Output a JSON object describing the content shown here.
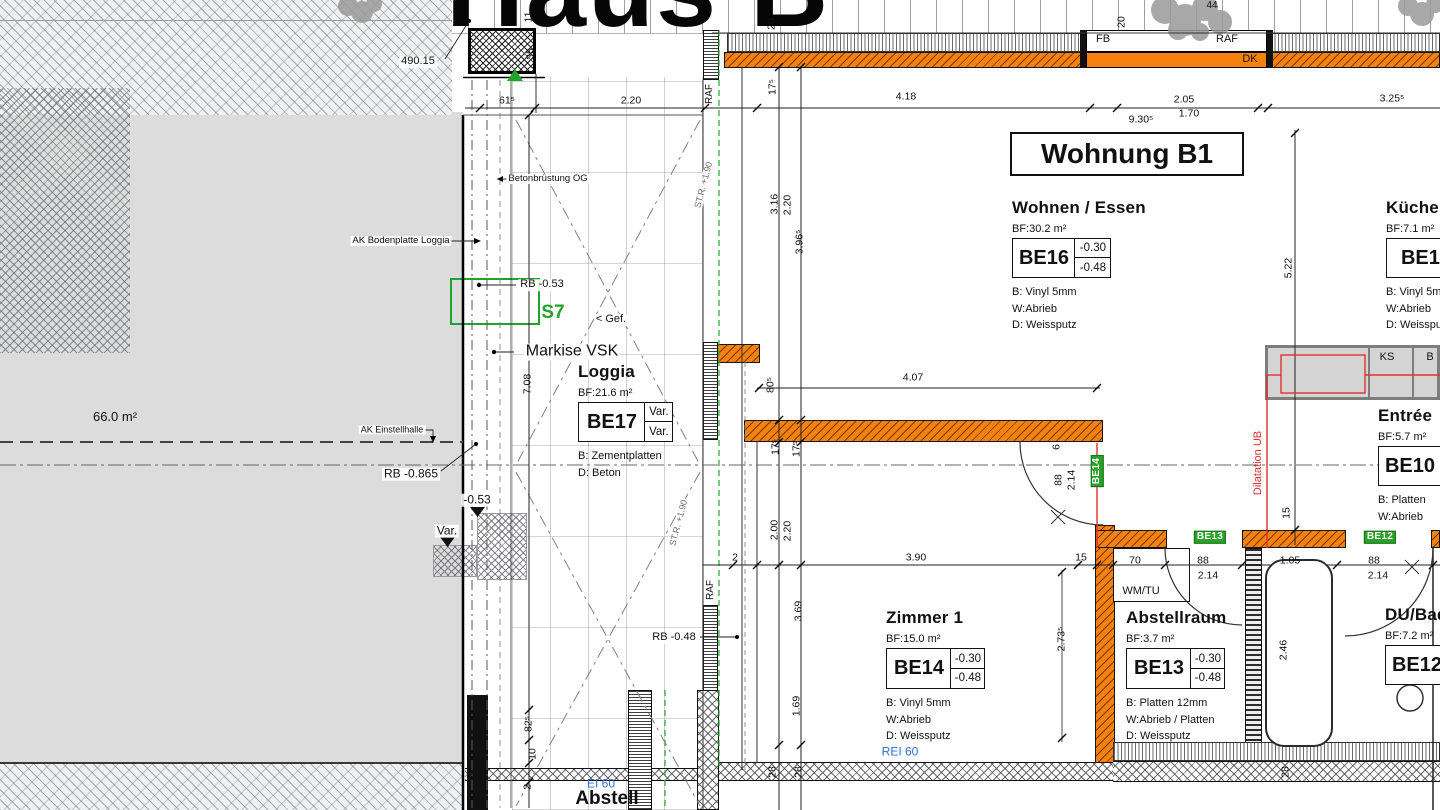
{
  "sheet_title": "Haus B",
  "apartment_title": "Wohnung B1",
  "colors": {
    "wall_orange": "#F5820F",
    "accent_green": "#1FA32A",
    "accent_red": "#DF312B",
    "fire_blue": "#2E6FD2",
    "hall_gray": "#DCDCDC"
  },
  "rooms": {
    "wohnen": {
      "name": "Wohnen / Essen",
      "area": "BF:30.2 m²",
      "code": "BE16",
      "lv1": "-0.30",
      "lv2": "-0.48",
      "layers": [
        "B: Vinyl 5mm",
        "W:Abrieb",
        "D: Weissputz"
      ]
    },
    "kueche": {
      "name": "Küche",
      "area": "BF:7.1 m²",
      "code": "BE15",
      "layers": [
        "B: Vinyl 5mm",
        "W:Abrieb",
        "D: Weissputz"
      ]
    },
    "loggia": {
      "name": "Loggia",
      "area": "BF:21.6 m²",
      "code": "BE17",
      "lv1": "Var.",
      "lv2": "Var.",
      "layers": [
        "B: Zementplatten",
        "D: Beton"
      ]
    },
    "entree": {
      "name": "Entrée",
      "area": "BF:5.7 m²",
      "code": "BE10",
      "layers": [
        "B: Platten",
        "W:Abrieb"
      ]
    },
    "zimmer1": {
      "name": "Zimmer 1",
      "area": "BF:15.0 m²",
      "code": "BE14",
      "lv1": "-0.30",
      "lv2": "-0.48",
      "layers": [
        "B: Vinyl 5mm",
        "W:Abrieb",
        "D: Weissputz"
      ]
    },
    "abstellraum": {
      "name": "Abstellraum",
      "area": "BF:3.7 m²",
      "code": "BE13",
      "lv1": "-0.30",
      "lv2": "-0.48",
      "layers": [
        "B: Platten 12mm",
        "W:Abrieb / Platten",
        "D: Weissputz"
      ]
    },
    "dubad": {
      "name": "DU/Bad",
      "area": "BF:7.2 m²",
      "code": "BE12",
      "layers": []
    }
  },
  "dims": [
    {
      "t": "11",
      "x": 529,
      "y": 17,
      "r": -90
    },
    {
      "t": "35",
      "x": 531,
      "y": 54,
      "r": -90
    },
    {
      "t": "61⁵",
      "x": 507,
      "y": 101
    },
    {
      "t": "2.20",
      "x": 631,
      "y": 101
    },
    {
      "t": "20",
      "x": 772,
      "y": 24,
      "r": -90
    },
    {
      "t": "17⁵",
      "x": 773,
      "y": 87,
      "r": -90
    },
    {
      "t": "20",
      "x": 1122,
      "y": 22,
      "r": -90
    },
    {
      "t": "4.18",
      "x": 906,
      "y": 97
    },
    {
      "t": "2.05",
      "x": 1184,
      "y": 100
    },
    {
      "t": "3.25⁵",
      "x": 1392,
      "y": 99
    },
    {
      "t": "9.30⁵",
      "x": 1141,
      "y": 120
    },
    {
      "t": "1.70",
      "x": 1189,
      "y": 114
    },
    {
      "t": "3.16",
      "x": 775,
      "y": 204,
      "r": -90
    },
    {
      "t": "2.20",
      "x": 788,
      "y": 205,
      "r": -90
    },
    {
      "t": "3.96⁵",
      "x": 800,
      "y": 242,
      "r": -90
    },
    {
      "t": "5.22",
      "x": 1289,
      "y": 268,
      "r": -90
    },
    {
      "t": "7.08",
      "x": 528,
      "y": 384,
      "r": -90
    },
    {
      "t": "80⁵",
      "x": 771,
      "y": 385,
      "r": -90
    },
    {
      "t": "4.07",
      "x": 913,
      "y": 378
    },
    {
      "t": "17⁵",
      "x": 776,
      "y": 447,
      "r": -90
    },
    {
      "t": "17⁵",
      "x": 797,
      "y": 449,
      "r": -90
    },
    {
      "t": "2.00",
      "x": 775,
      "y": 530,
      "r": -90
    },
    {
      "t": "2.20",
      "x": 788,
      "y": 531,
      "r": -90
    },
    {
      "t": "6",
      "x": 1057,
      "y": 447,
      "r": -90
    },
    {
      "t": "88",
      "x": 1059,
      "y": 480,
      "r": -90
    },
    {
      "t": "2.14",
      "x": 1072,
      "y": 480,
      "r": -90
    },
    {
      "t": "15",
      "x": 1287,
      "y": 513,
      "r": -90
    },
    {
      "t": "2",
      "x": 735,
      "y": 558
    },
    {
      "t": "3.90",
      "x": 916,
      "y": 558
    },
    {
      "t": "15",
      "x": 1081,
      "y": 558
    },
    {
      "t": "70",
      "x": 1135,
      "y": 561
    },
    {
      "t": "88",
      "x": 1203,
      "y": 561
    },
    {
      "t": "2.14",
      "x": 1208,
      "y": 576
    },
    {
      "t": "1.05",
      "x": 1290,
      "y": 561
    },
    {
      "t": "88",
      "x": 1374,
      "y": 561
    },
    {
      "t": "2.14",
      "x": 1378,
      "y": 576
    },
    {
      "t": "3.69",
      "x": 799,
      "y": 611,
      "r": -90
    },
    {
      "t": "2.73⁵",
      "x": 1062,
      "y": 639,
      "r": -90
    },
    {
      "t": "1.69",
      "x": 797,
      "y": 706,
      "r": -90
    },
    {
      "t": "2.46",
      "x": 1284,
      "y": 650,
      "r": -90
    },
    {
      "t": "82⁵",
      "x": 529,
      "y": 724,
      "r": -90
    },
    {
      "t": "10",
      "x": 533,
      "y": 754,
      "r": -90
    },
    {
      "t": "2",
      "x": 528,
      "y": 787,
      "r": -90
    },
    {
      "t": "28",
      "x": 773,
      "y": 772,
      "r": -90
    },
    {
      "t": "28",
      "x": 799,
      "y": 772,
      "r": -90
    },
    {
      "t": "28",
      "x": 1286,
      "y": 772,
      "r": -90
    }
  ],
  "labels": [
    {
      "t": "490.15",
      "x": 418,
      "y": 62,
      "s": 11,
      "cls": "wbg",
      "n": "survey-elevation-label"
    },
    {
      "t": "44",
      "x": 1212,
      "y": 6,
      "s": 10,
      "n": "tree-label"
    },
    {
      "t": "Betonbrüstung OG",
      "x": 548,
      "y": 179,
      "s": 9.5,
      "cls": "wbg",
      "n": "parapet-annotation"
    },
    {
      "t": "AK Bodenplatte Loggia",
      "x": 401,
      "y": 241,
      "s": 9.5,
      "cls": "wbg",
      "n": "loggia-slab-annotation"
    },
    {
      "t": "RB -0.53",
      "x": 542,
      "y": 285,
      "s": 11,
      "cls": "wbg",
      "n": "level-annotation"
    },
    {
      "t": "S7",
      "x": 553,
      "y": 313,
      "s": 19,
      "cls": "b green",
      "n": "section-marker"
    },
    {
      "t": "< Gef.",
      "x": 611,
      "y": 320,
      "s": 11,
      "cls": "wbg",
      "n": "slope-annotation"
    },
    {
      "t": "Markise VSK",
      "x": 572,
      "y": 352,
      "s": 16,
      "cls": "wbg",
      "n": "awning-annotation"
    },
    {
      "t": "66.0 m²",
      "x": 115,
      "y": 417,
      "s": 13,
      "n": "hall-area-label"
    },
    {
      "t": "AK Einstellhalle",
      "x": 392,
      "y": 430,
      "s": 9,
      "cls": "wbg",
      "n": "hall-annotation"
    },
    {
      "t": "RB -0.865",
      "x": 411,
      "y": 474,
      "s": 12,
      "cls": "wbg",
      "n": "hall-level-annotation"
    },
    {
      "t": "-0.53",
      "x": 477,
      "y": 500,
      "s": 12,
      "cls": "wbg",
      "n": "level-marker"
    },
    {
      "t": "Var.",
      "x": 447,
      "y": 531,
      "s": 12,
      "cls": "wbg",
      "n": "var-marker"
    },
    {
      "t": "RB -0.48",
      "x": 674,
      "y": 638,
      "s": 11,
      "cls": "wbg",
      "n": "level-annotation"
    },
    {
      "t": "Abstell",
      "x": 607,
      "y": 799,
      "s": 19,
      "cls": "b",
      "n": "room-label-abstell"
    },
    {
      "t": "EI 60",
      "x": 601,
      "y": 784,
      "s": 12,
      "cls": "blue",
      "n": "fire-rating-label"
    },
    {
      "t": "REI 60",
      "x": 900,
      "y": 752,
      "s": 12,
      "cls": "blue",
      "n": "fire-rating-label"
    },
    {
      "t": "RAF",
      "x": 710,
      "y": 94,
      "s": 10,
      "r": -90,
      "n": "window-frame-label"
    },
    {
      "t": "RAF",
      "x": 711,
      "y": 590,
      "s": 10,
      "r": -90,
      "n": "window-frame-label"
    },
    {
      "t": "FB",
      "x": 1103,
      "y": 40,
      "s": 11,
      "n": "window-frame-label"
    },
    {
      "t": "RAF",
      "x": 1227,
      "y": 40,
      "s": 11,
      "n": "window-frame-label"
    },
    {
      "t": "DK",
      "x": 1250,
      "y": 60,
      "s": 11,
      "n": "window-sill-label"
    },
    {
      "t": "KS",
      "x": 1387,
      "y": 358,
      "s": 11,
      "n": "kitchen-unit-label"
    },
    {
      "t": "B",
      "x": 1430,
      "y": 358,
      "s": 11,
      "n": "kitchen-unit-label"
    },
    {
      "t": "WM/TU",
      "x": 1141,
      "y": 592,
      "s": 11,
      "n": "appliance-label"
    },
    {
      "t": "Dilatation UB",
      "x": 1259,
      "y": 463,
      "s": 11,
      "r": -90,
      "cls": "red",
      "n": "dilatation-annotation"
    },
    {
      "t": "ST.R. +1.90",
      "x": 704,
      "y": 185,
      "s": 9,
      "r": -75,
      "cls": "gray wbg",
      "n": "railing-annotation"
    },
    {
      "t": "ST.R. +1.90",
      "x": 679,
      "y": 523,
      "s": 9,
      "r": -75,
      "cls": "gray wbg",
      "n": "railing-annotation"
    },
    {
      "t": "BE14",
      "x": 1097,
      "y": 471,
      "r": -90,
      "cls": "tag",
      "n": "wall-finish-tag"
    },
    {
      "t": "BE13",
      "x": 1210,
      "y": 537,
      "cls": "tag",
      "n": "wall-finish-tag"
    },
    {
      "t": "BE12",
      "x": 1380,
      "y": 537,
      "cls": "tag",
      "n": "wall-finish-tag"
    }
  ]
}
